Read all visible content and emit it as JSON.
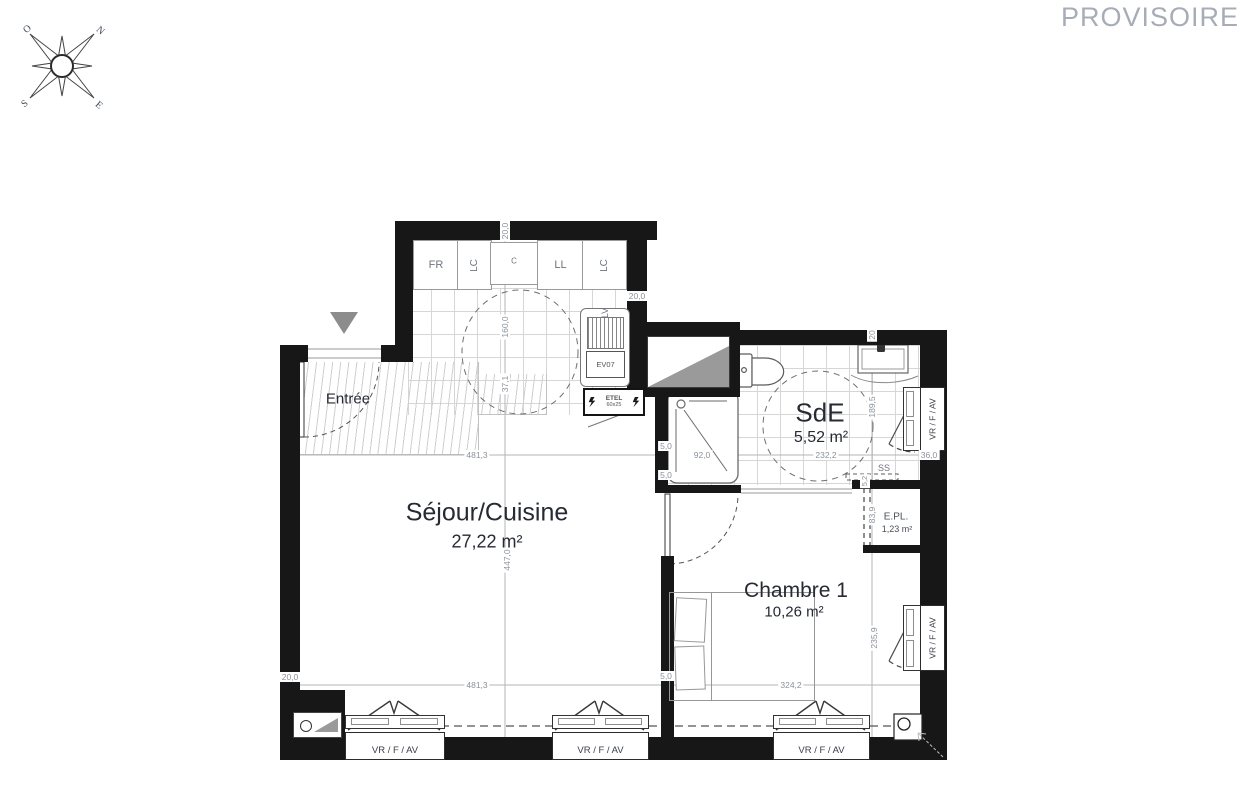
{
  "watermark": "PROVISOIRE",
  "compass": {
    "north": "N",
    "south": "S",
    "east": "E",
    "west": "O"
  },
  "rooms": {
    "entree": {
      "name": "Entrée"
    },
    "sejour": {
      "name": "Séjour/Cuisine",
      "area": "27,22 m²"
    },
    "sde": {
      "name": "SdE",
      "area": "5,52 m²"
    },
    "chambre": {
      "name": "Chambre 1",
      "area": "10,26 m²"
    },
    "epl": {
      "name": "E.PL.",
      "area": "1,23 m²"
    }
  },
  "kitchen": {
    "fr": "FR",
    "lc1": "LC",
    "c": "C",
    "ll": "LL",
    "lc2": "LC",
    "lv": "LV",
    "duct": "EV07"
  },
  "etel": {
    "name": "ETEL",
    "size": "60x25"
  },
  "window_label": "VR / F / AV",
  "dims": {
    "d20_0": "20,0",
    "d20": "20",
    "d160": "160,0",
    "d37_1": "37,1",
    "d447": "447,0",
    "d481_3": "481,3",
    "d5_0": "5,0",
    "d92": "92,0",
    "d232_2": "232,2",
    "d189_5": "189,5",
    "d36_0": "36,0",
    "d5_2": "5,2",
    "d83_9": "83,9",
    "d324_2": "324,2",
    "d235_9": "235,9",
    "ss": "SS"
  },
  "colors": {
    "wall": "#171717",
    "dim_text": "#8a919c",
    "watermark": "#a7adb6",
    "landing_fill": "#9a9a9a"
  }
}
